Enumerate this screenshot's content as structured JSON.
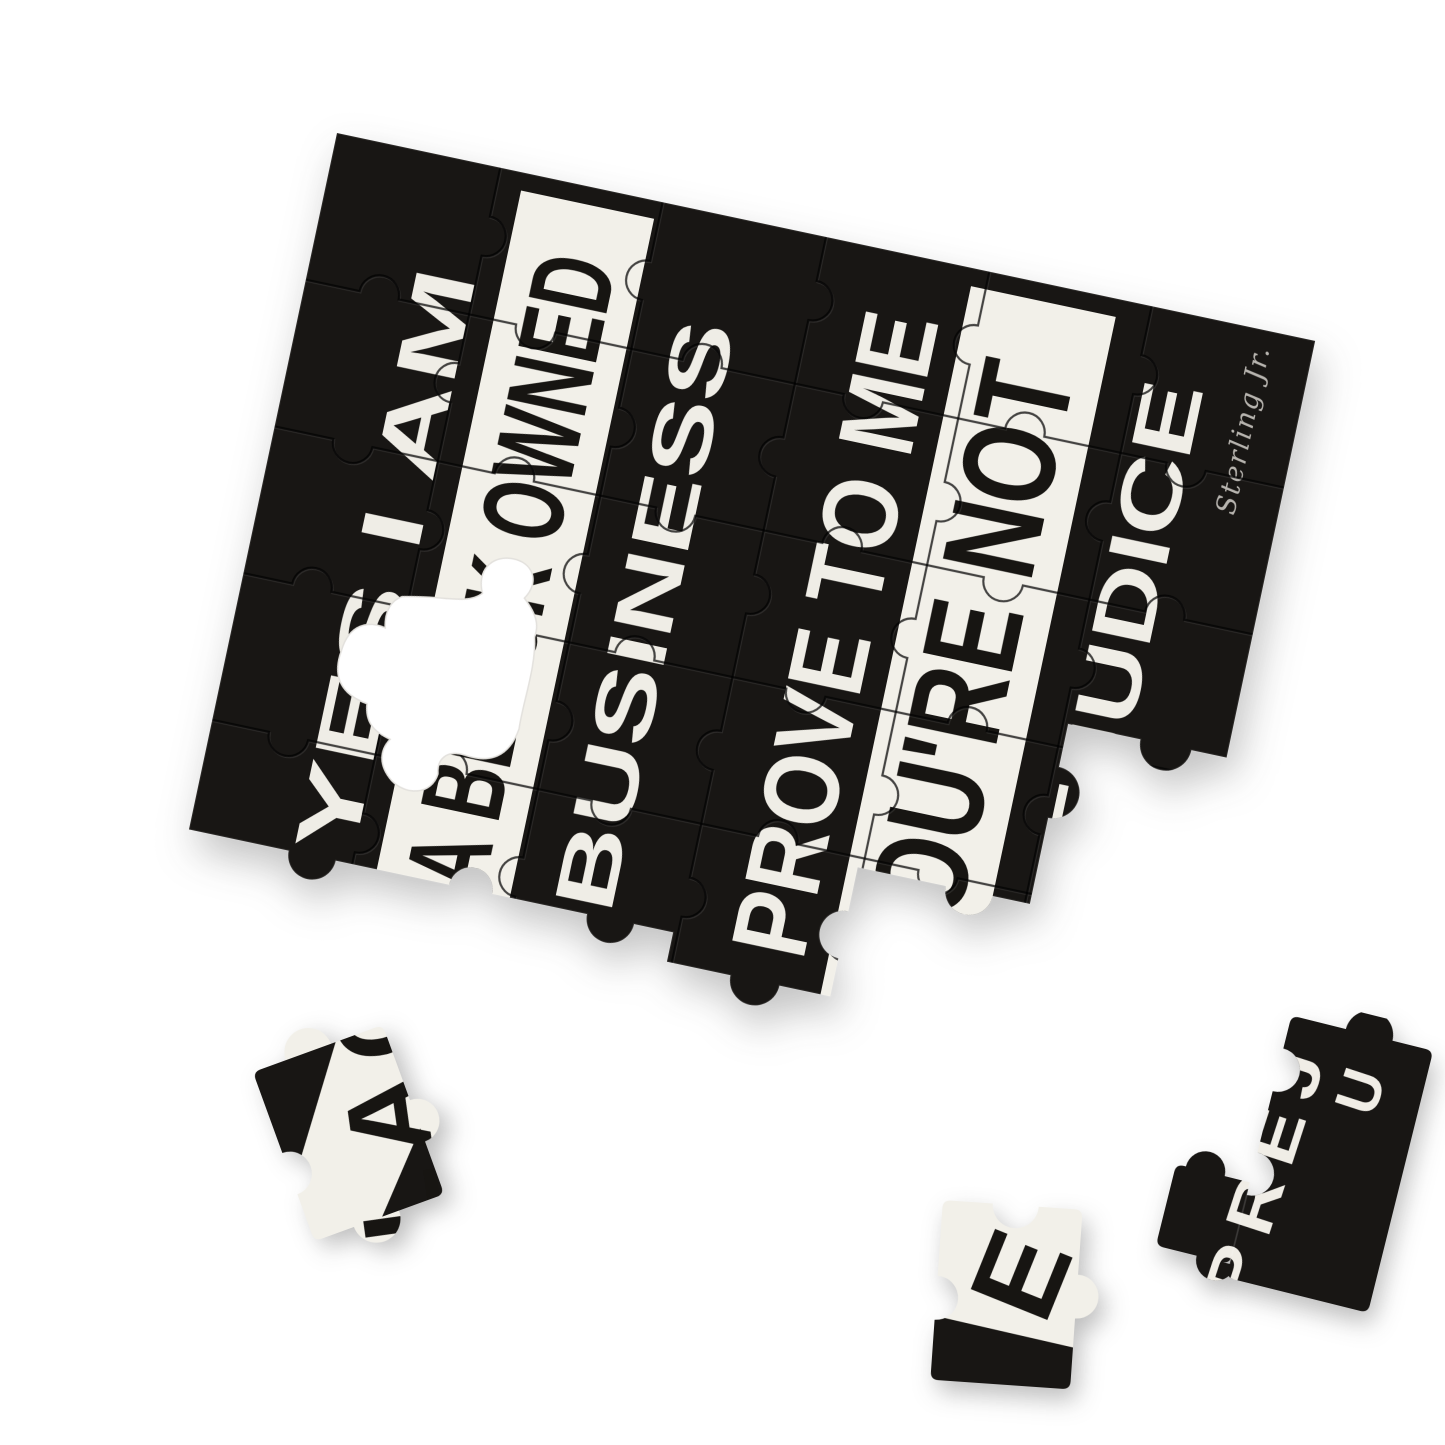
{
  "scene": {
    "background_color": "#ffffff",
    "shadow_color": "rgba(40,40,40,0.3)"
  },
  "puzzle": {
    "board_color": "#181614",
    "text_color": "#efede6",
    "band_color": "#f2f0e9",
    "band_text_color": "#171512",
    "lines": [
      {
        "id": "line-1",
        "text": "YES I AM",
        "style": "light-on-dark"
      },
      {
        "id": "line-2",
        "text": "A BLACK OWNED",
        "style": "dark-on-band"
      },
      {
        "id": "line-3",
        "text": "BUSINESS",
        "style": "light-on-dark"
      },
      {
        "id": "line-4",
        "text": "PROVE TO ME",
        "style": "light-on-dark"
      },
      {
        "id": "line-5",
        "text": "YOU'RE NOT",
        "style": "dark-on-band"
      },
      {
        "id": "line-6",
        "text": "PREJUDICE",
        "style": "light-on-dark"
      }
    ],
    "signature": "Sterling Jr.",
    "missing_piece_hole": "white puzzle-piece shaped gap"
  },
  "loose_pieces": [
    {
      "id": "piece-left",
      "letters": "LAC"
    },
    {
      "id": "piece-center",
      "letters": "E"
    },
    {
      "id": "piece-right",
      "letters": "PREJ",
      "letters_extra": "U"
    }
  ]
}
